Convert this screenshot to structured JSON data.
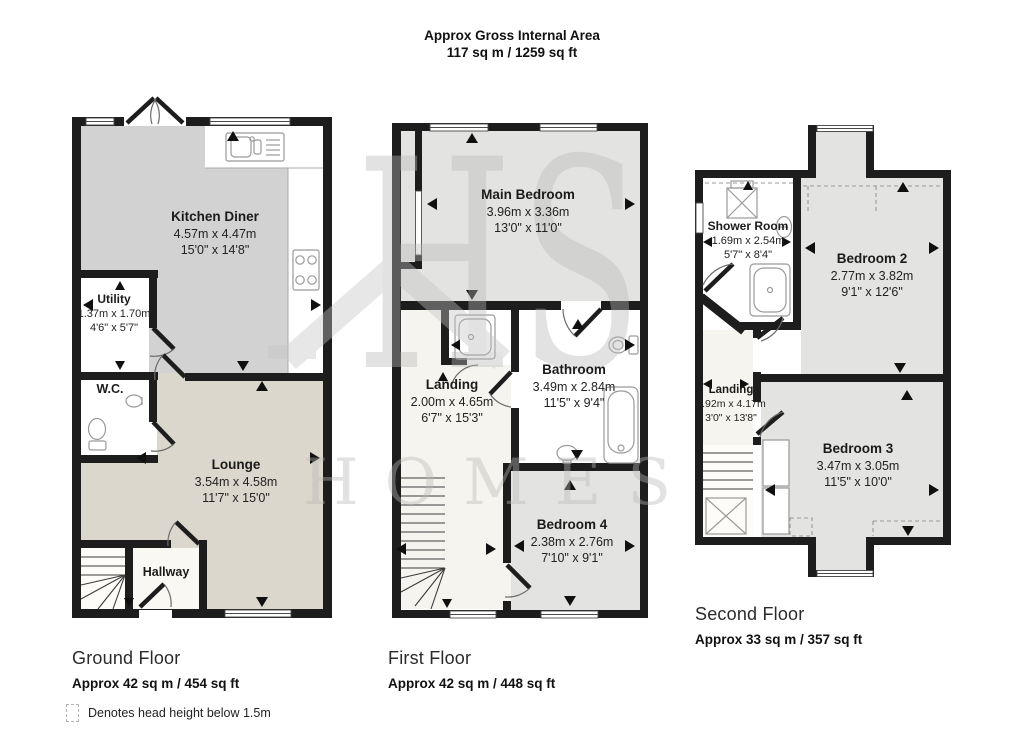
{
  "header": {
    "line1": "Approx Gross Internal Area",
    "line2": "117 sq m / 1259 sq ft"
  },
  "watermark": {
    "line1": "HS",
    "line2": "HOMES"
  },
  "legend": {
    "text": "Denotes head height below 1.5m"
  },
  "colors": {
    "wall": "#1d1d1d",
    "kitchen_fill": "#d2d2d2",
    "lounge_fill": "#dcd7cc",
    "bedroom_fill": "#e3e3e2",
    "landing_fill": "#f6f4ef",
    "watermark": "#b9b9b9"
  },
  "floors": [
    {
      "name": "Ground Floor",
      "area": "Approx 42 sq m / 454 sq ft",
      "fixtures": [
        "kitchen-sink",
        "hob",
        "wc-toilet",
        "wc-basin",
        "stairs"
      ],
      "rooms": [
        {
          "name": "Kitchen Diner",
          "dim_m": "4.57m x 4.47m",
          "dim_ft": "15'0\" x 14'8\""
        },
        {
          "name": "Utility",
          "dim_m": "1.37m x 1.70m",
          "dim_ft": "4'6\" x 5'7\""
        },
        {
          "name": "W.C.",
          "dim_m": "",
          "dim_ft": ""
        },
        {
          "name": "Lounge",
          "dim_m": "3.54m x 4.58m",
          "dim_ft": "11'7\" x 15'0\""
        },
        {
          "name": "Hallway",
          "dim_m": "",
          "dim_ft": ""
        }
      ]
    },
    {
      "name": "First Floor",
      "area": "Approx 42 sq m / 448 sq ft",
      "fixtures": [
        "shower-tray",
        "toilet",
        "bathtub",
        "basin",
        "stairs"
      ],
      "rooms": [
        {
          "name": "Main Bedroom",
          "dim_m": "3.96m x 3.36m",
          "dim_ft": "13'0\" x 11'0\""
        },
        {
          "name": "Landing",
          "dim_m": "2.00m x 4.65m",
          "dim_ft": "6'7\" x 15'3\""
        },
        {
          "name": "Bathroom",
          "dim_m": "3.49m x 2.84m",
          "dim_ft": "11'5\" x 9'4\""
        },
        {
          "name": "Bedroom 4",
          "dim_m": "2.38m x 2.76m",
          "dim_ft": "7'10\" x 9'1\""
        }
      ]
    },
    {
      "name": "Second Floor",
      "area": "Approx 33 sq m / 357 sq ft",
      "fixtures": [
        "shower-cubicle",
        "basin",
        "shower-tray",
        "stairs",
        "rooflight",
        "cupboards"
      ],
      "rooms": [
        {
          "name": "Shower Room",
          "dim_m": "1.69m x 2.54m",
          "dim_ft": "5'7\" x 8'4\""
        },
        {
          "name": "Bedroom 2",
          "dim_m": "2.77m x 3.82m",
          "dim_ft": "9'1\" x 12'6\""
        },
        {
          "name": "Landing",
          "dim_m": "0.92m x 4.17m",
          "dim_ft": "3'0\" x 13'8\""
        },
        {
          "name": "Bedroom 3",
          "dim_m": "3.47m x 3.05m",
          "dim_ft": "11'5\" x 10'0\""
        }
      ]
    }
  ]
}
